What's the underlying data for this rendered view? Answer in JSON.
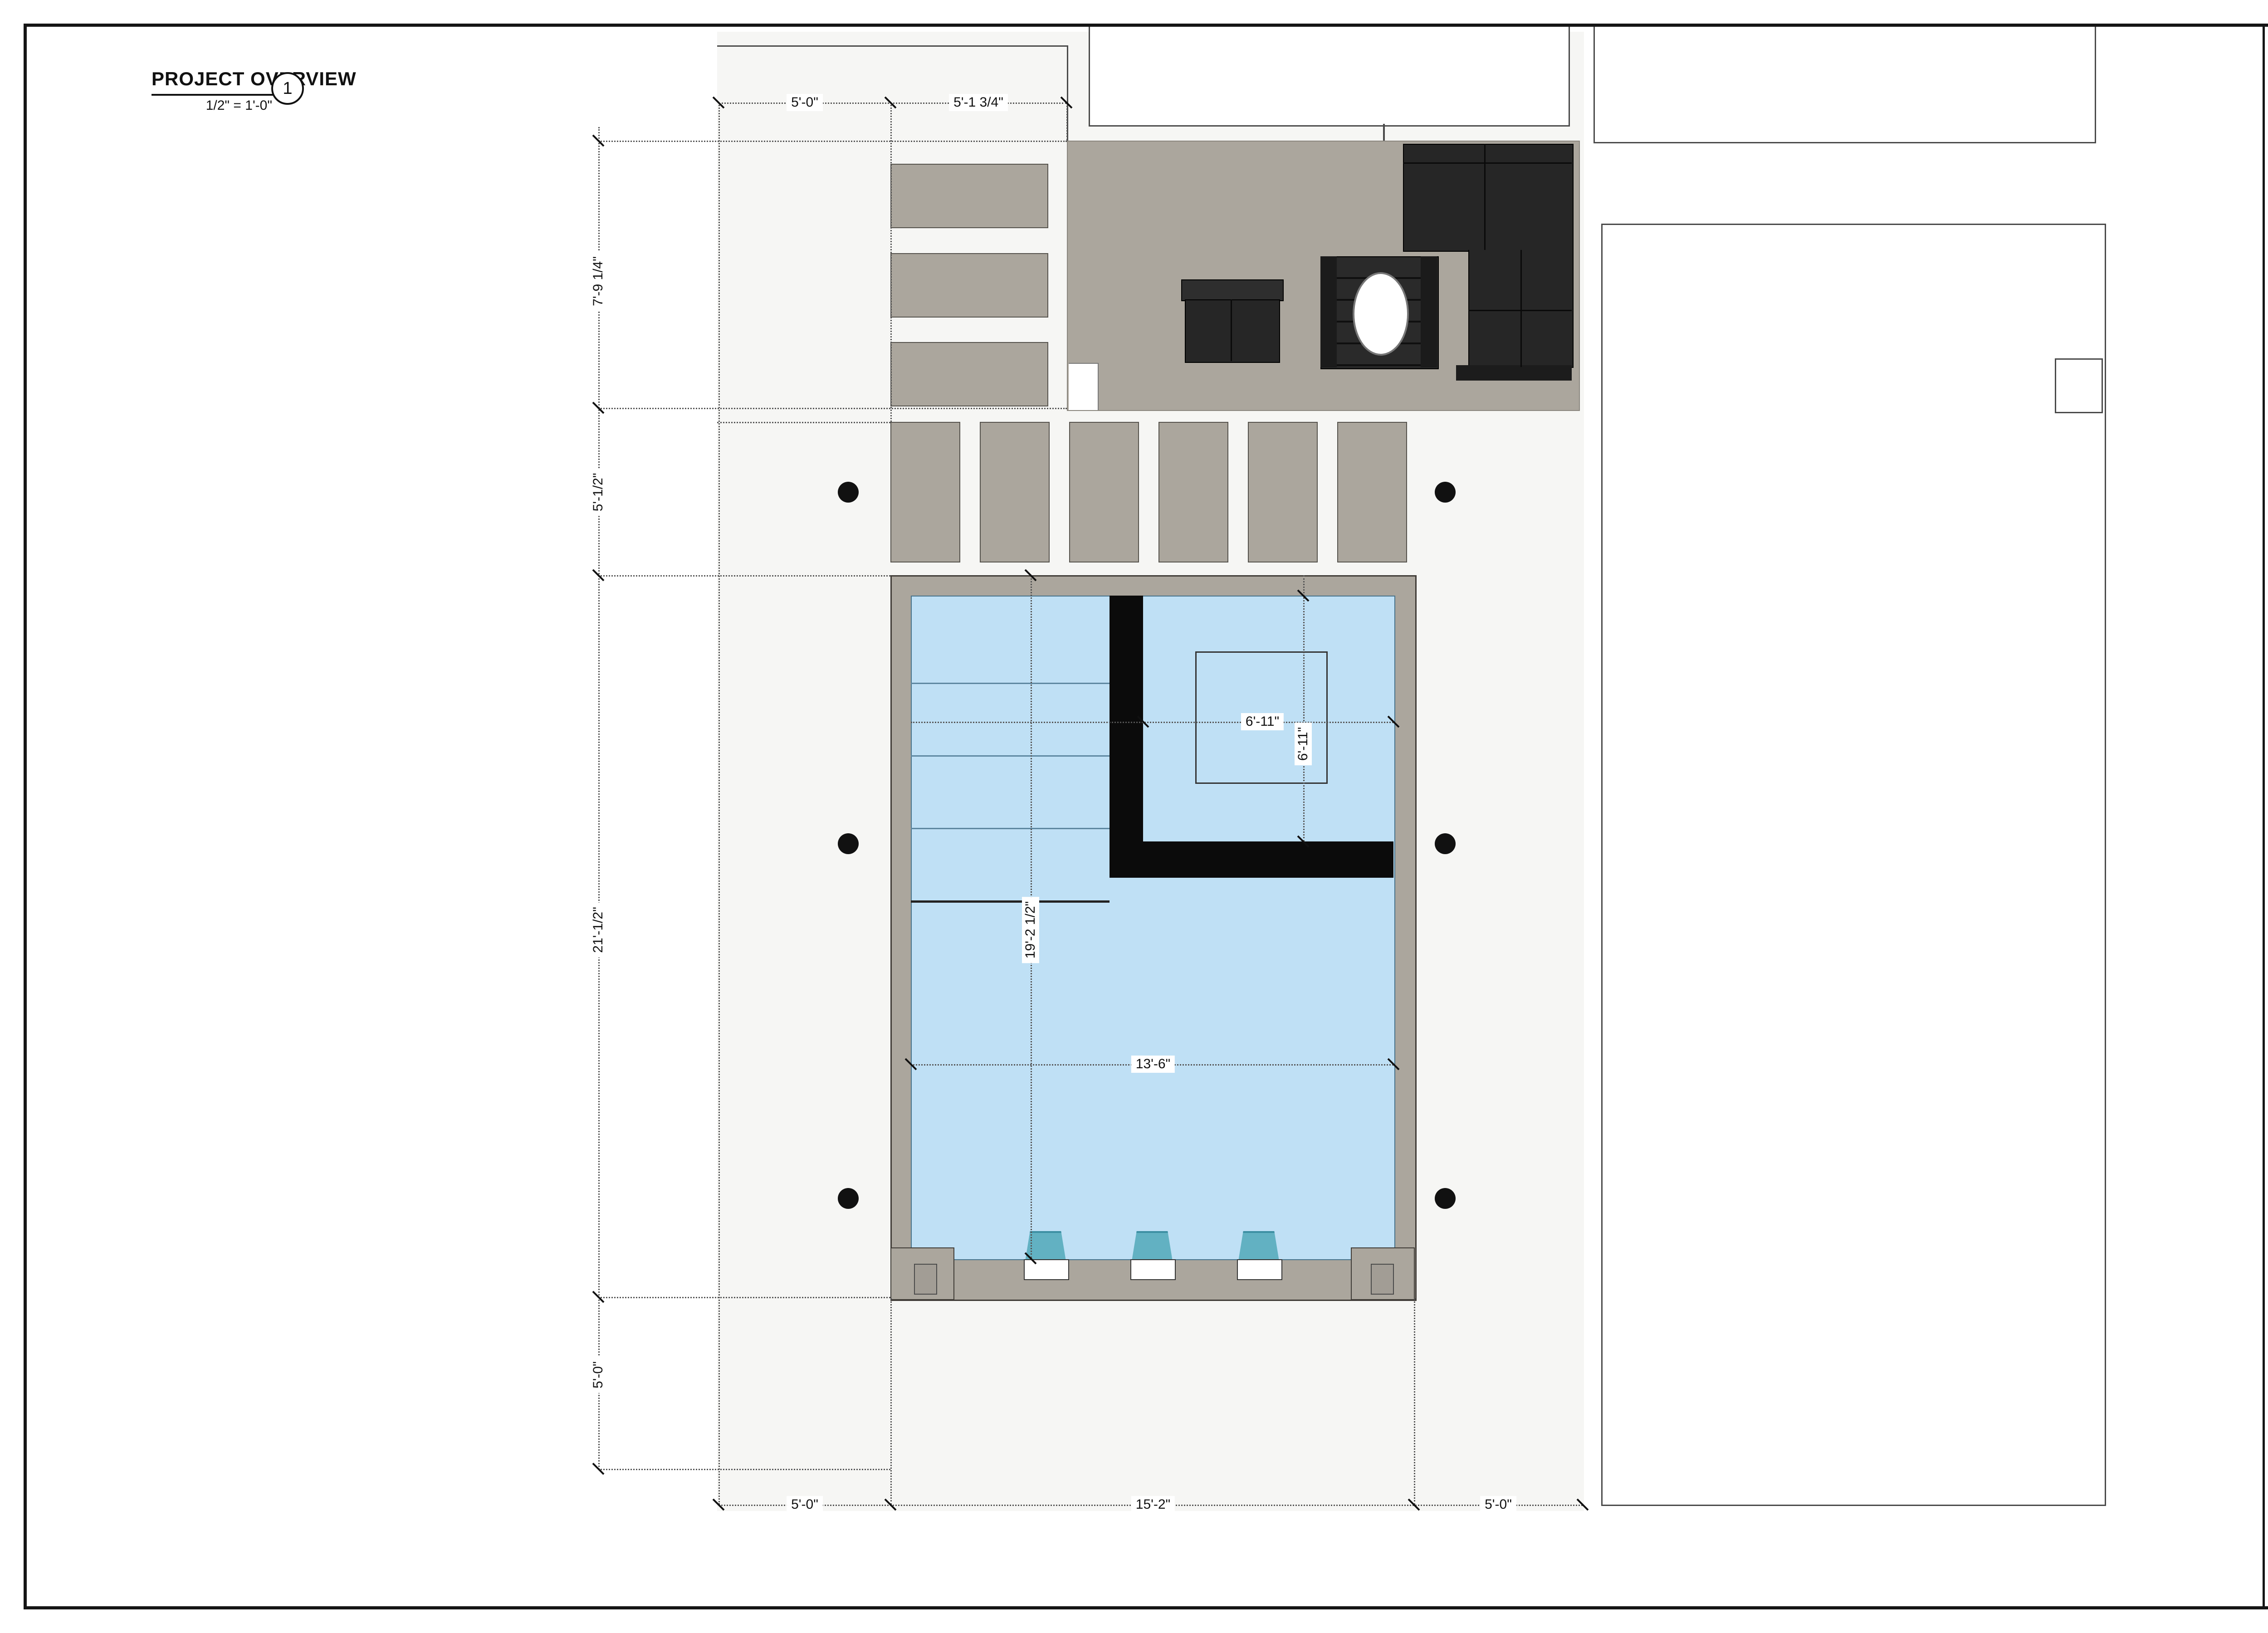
{
  "view": {
    "title": "PROJECT OVERVIEW",
    "scale": "1/2\" = 1'-0\"",
    "number": "1"
  },
  "firm": {
    "logo": "PRATT GUYS",
    "contact": "6967 PHILLIPS HWY. | JACKSONVILLE, FL 32216 | 904.737.4652 | CBC 056685 | CPC 056645"
  },
  "revisions": {
    "headers": [
      "DATE",
      "REVISION"
    ],
    "rows": [
      {
        "date": "11/4/24",
        "revision": "A-9, A-11"
      }
    ]
  },
  "copyright": {
    "text": "All of the Plans, Images and Content in this document are protected under United States copyright laws. Reproduction of the plans or images in any way is strictly prohibited."
  },
  "project": {
    "name": "FAILOR RESIDENCE",
    "address_line1": "334 2nd Street",
    "address_line2": "Atlantic Beach, FL 32233",
    "number_label": "PROJECT NO.",
    "number": "24024",
    "date_label": "DATE:",
    "date": "12/13/2024",
    "designer_label": "DESIGNER:",
    "designer": "CHRIS EITEL"
  },
  "sheet": {
    "title_line1": "DESIGN LAYOUT-1",
    "title_line2": "DIMENSIONS",
    "number": "A-6"
  },
  "dims": {
    "top": [
      "5'-0\"",
      "5'-1 3/4\""
    ],
    "left": [
      "7'-9 1/4\"",
      "5'-1/2\"",
      "21'-1/2\"",
      "5'-0\""
    ],
    "bottom": [
      "5'-0\"",
      "15'-2\"",
      "5'-0\""
    ],
    "pool": [
      "6'-11\"",
      "6'-11\"",
      "19'-2 1/2\"",
      "13'-6\""
    ]
  },
  "colors": {
    "water": "#bfe0f5",
    "hardscape": "#aba69d",
    "scupper": "#62b1c2",
    "wall": "#0b0b0b",
    "paper": "#ffffff"
  }
}
